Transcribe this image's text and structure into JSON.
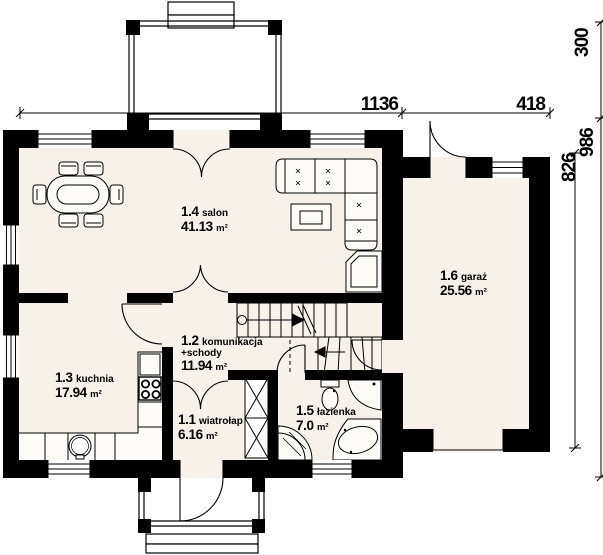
{
  "rooms": [
    {
      "id": "1.1",
      "name": "wiatrołap",
      "area": "6.16",
      "unit": "m²"
    },
    {
      "id": "1.2",
      "name": "komunikacja",
      "name2": "+schody",
      "area": "11.94",
      "unit": "m²"
    },
    {
      "id": "1.3",
      "name": "kuchnia",
      "area": "17.94",
      "unit": "m²"
    },
    {
      "id": "1.4",
      "name": "salon",
      "area": "41.13",
      "unit": "m²"
    },
    {
      "id": "1.5",
      "name": "łazienka",
      "area": "7.0",
      "unit": "m²"
    },
    {
      "id": "1.6",
      "name": "garaż",
      "area": "25.56",
      "unit": "m²"
    }
  ],
  "dims": {
    "main_width": "1136",
    "garage_width": "418",
    "terrace_depth": "300",
    "house_depth": "986",
    "garage_depth": "826"
  },
  "colors": {
    "wall": "#000000",
    "floor": "#f7f1e9",
    "fixture": "#fdfbf7",
    "background": "#ffffff"
  }
}
